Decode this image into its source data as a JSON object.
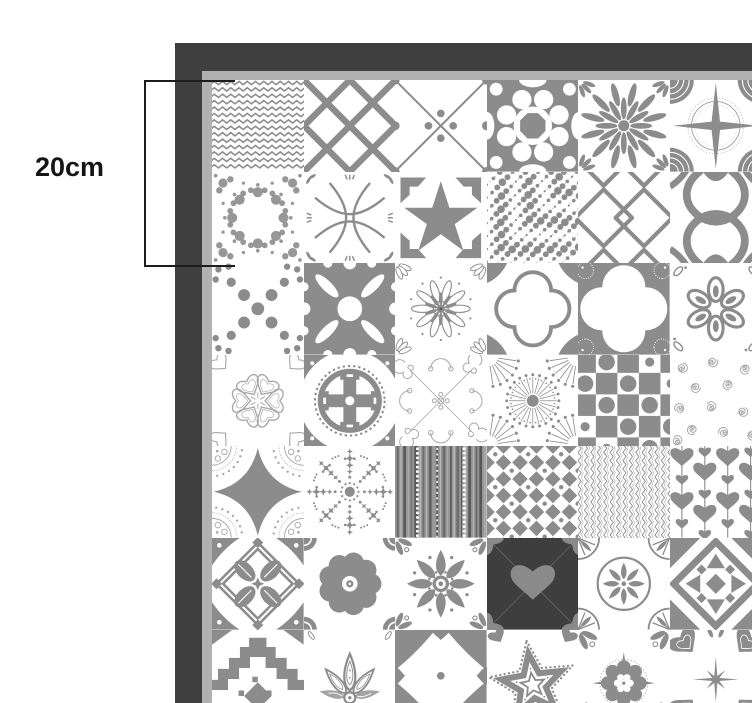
{
  "page": {
    "type": "tile-sheet-dimension-illustration"
  },
  "annotation": {
    "label": "20cm",
    "bracket_tiles_spanned": 2
  },
  "colors": {
    "background": "#ffffff",
    "frame": "#3f3f3f",
    "backing": "#b1b1b1",
    "tile_gray": "#8c8c8c",
    "tile_light": "#a8a8a8",
    "dark_tile": "#3e3e3e",
    "dark_tile_motif": "#8a8a8a",
    "annotation_text": "#151515"
  },
  "sheet": {
    "rows": 7,
    "cols": 6,
    "pattern_grid": [
      [
        "chevron",
        "diamond-lattice",
        "diagonal-cross-dots",
        "circle-kaleidoscope",
        "daisy-flower",
        "compass-star"
      ],
      [
        "lace-medallion",
        "curved-petal-cross",
        "bold-star",
        "beaded-diagonals",
        "double-diamond",
        "ogee-ikat"
      ],
      [
        "dotted-x",
        "gear-ring",
        "flower-burst",
        "quatrefoil",
        "petal-cross",
        "loop-flower"
      ],
      [
        "heart-snowflake",
        "circle-cross-medallion",
        "filigree-swirls",
        "radial-dandelion",
        "checker-dots",
        "scattered-spirals"
      ],
      [
        "ornate-diamond",
        "star-ray-burst",
        "stripe-barcode",
        "octagon-dot-grid",
        "herringbone",
        "hanging-hearts"
      ],
      [
        "ribbon-diamond",
        "scalloped-flower",
        "petal-mandala",
        "dark-heart",
        "rosette-circle",
        "geometric-diamond-star"
      ],
      [
        "arabesque-arch",
        "paisley-lily",
        "corner-arc-flower",
        "dotted-star",
        "round-mandala",
        "hearts-sparkle"
      ]
    ]
  }
}
